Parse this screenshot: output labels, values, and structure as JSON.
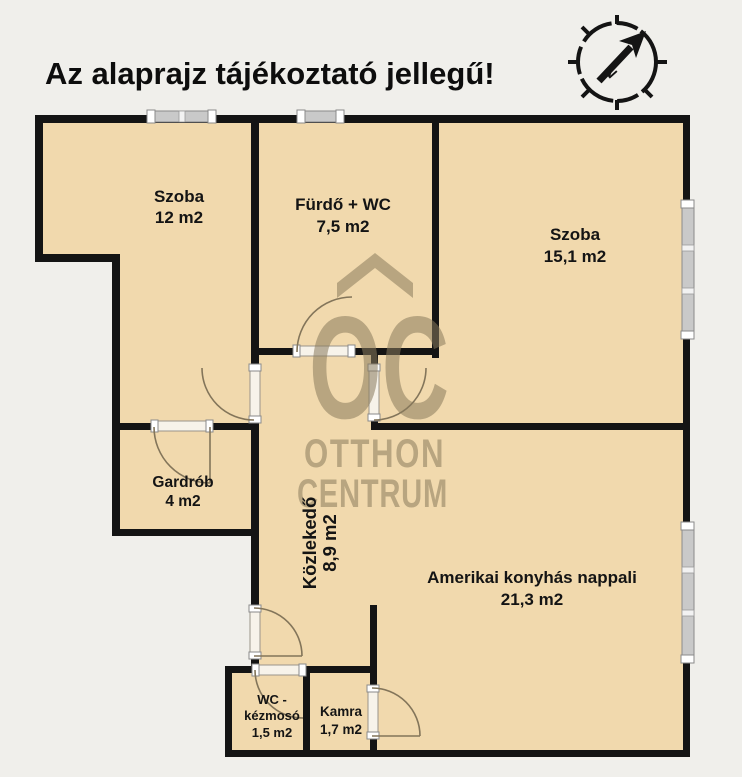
{
  "title": "Az alaprajz tájékoztató jellegű!",
  "compass": {
    "direction_label": "N"
  },
  "watermark": {
    "monogram": "OC",
    "line1": "OTTHON",
    "line2": "CENTRUM"
  },
  "rooms": {
    "szoba1": {
      "name": "Szoba",
      "area": "12 m2"
    },
    "furdo": {
      "name": "Fürdő + WC",
      "area": "7,5 m2"
    },
    "szoba2": {
      "name": "Szoba",
      "area": "15,1 m2"
    },
    "gardrob": {
      "name": "Gardrób",
      "area": "4 m2"
    },
    "kozlekedo": {
      "name": "Közlekedő",
      "area": "8,9 m2"
    },
    "nappali": {
      "name": "Amerikai konyhás nappali",
      "area": "21,3 m2"
    },
    "wc": {
      "name_line1": "WC -",
      "name_line2": "kézmosó",
      "area": "1,5 m2"
    },
    "kamra": {
      "name": "Kamra",
      "area": "1,7 m2"
    }
  },
  "colors": {
    "background": "#f0efeb",
    "floor": "#f1d9ad",
    "wall": "#141414",
    "watermark": "#8a7b5d",
    "door_arc": "#83755a",
    "window": "#c9c9c9",
    "text": "#141414"
  }
}
